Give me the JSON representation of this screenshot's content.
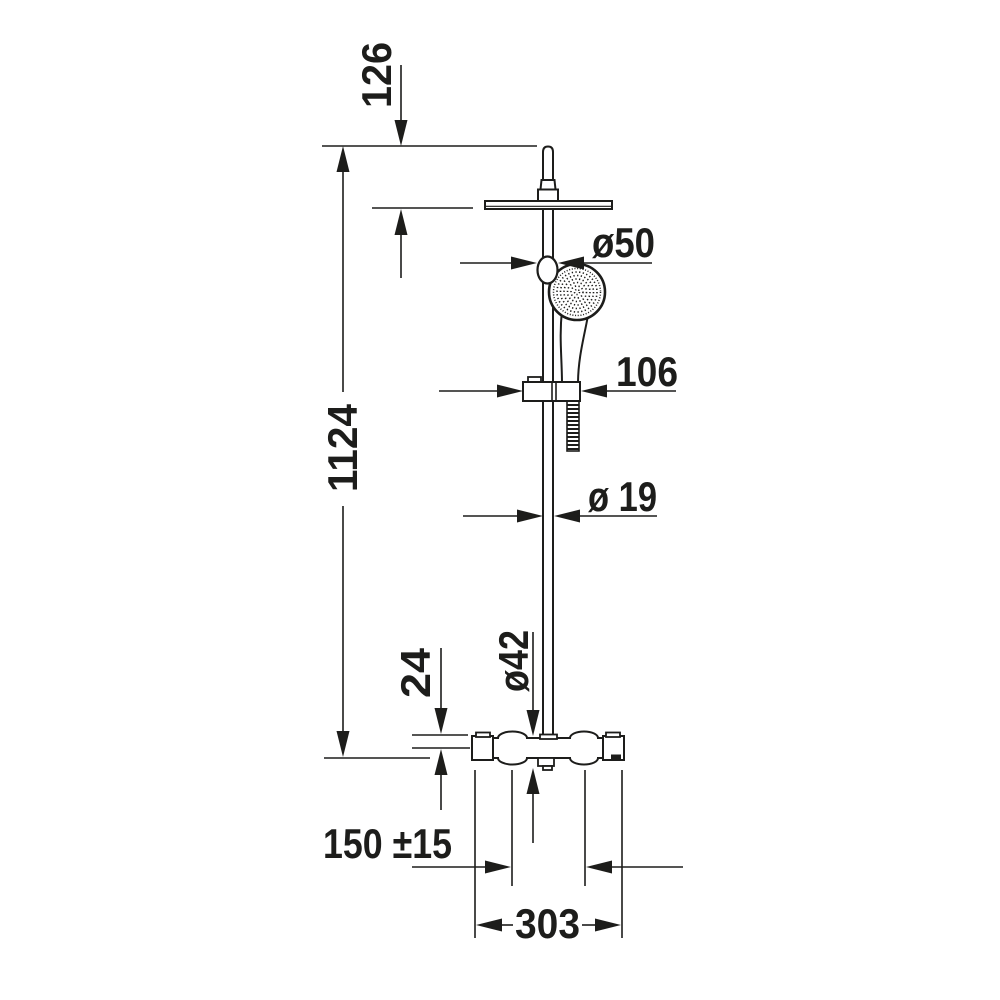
{
  "page": {
    "background": "#ffffff",
    "line_color": "#1d1d1b"
  },
  "drawing": {
    "kind": "dimensioned-technical-line-drawing",
    "subject": "shower column with overhead rain shower, hand shower on holder and thermostatic mixer valve"
  },
  "dimensions": {
    "top_to_head": "126",
    "total_height": "1124",
    "knob_diameter": "ø50",
    "holder_width": "106",
    "pipe_diameter": "ø 19",
    "valve_top_offset": "24",
    "valve_diameter": "ø42",
    "inlet_spacing": "150 ±15",
    "valve_width": "303"
  }
}
